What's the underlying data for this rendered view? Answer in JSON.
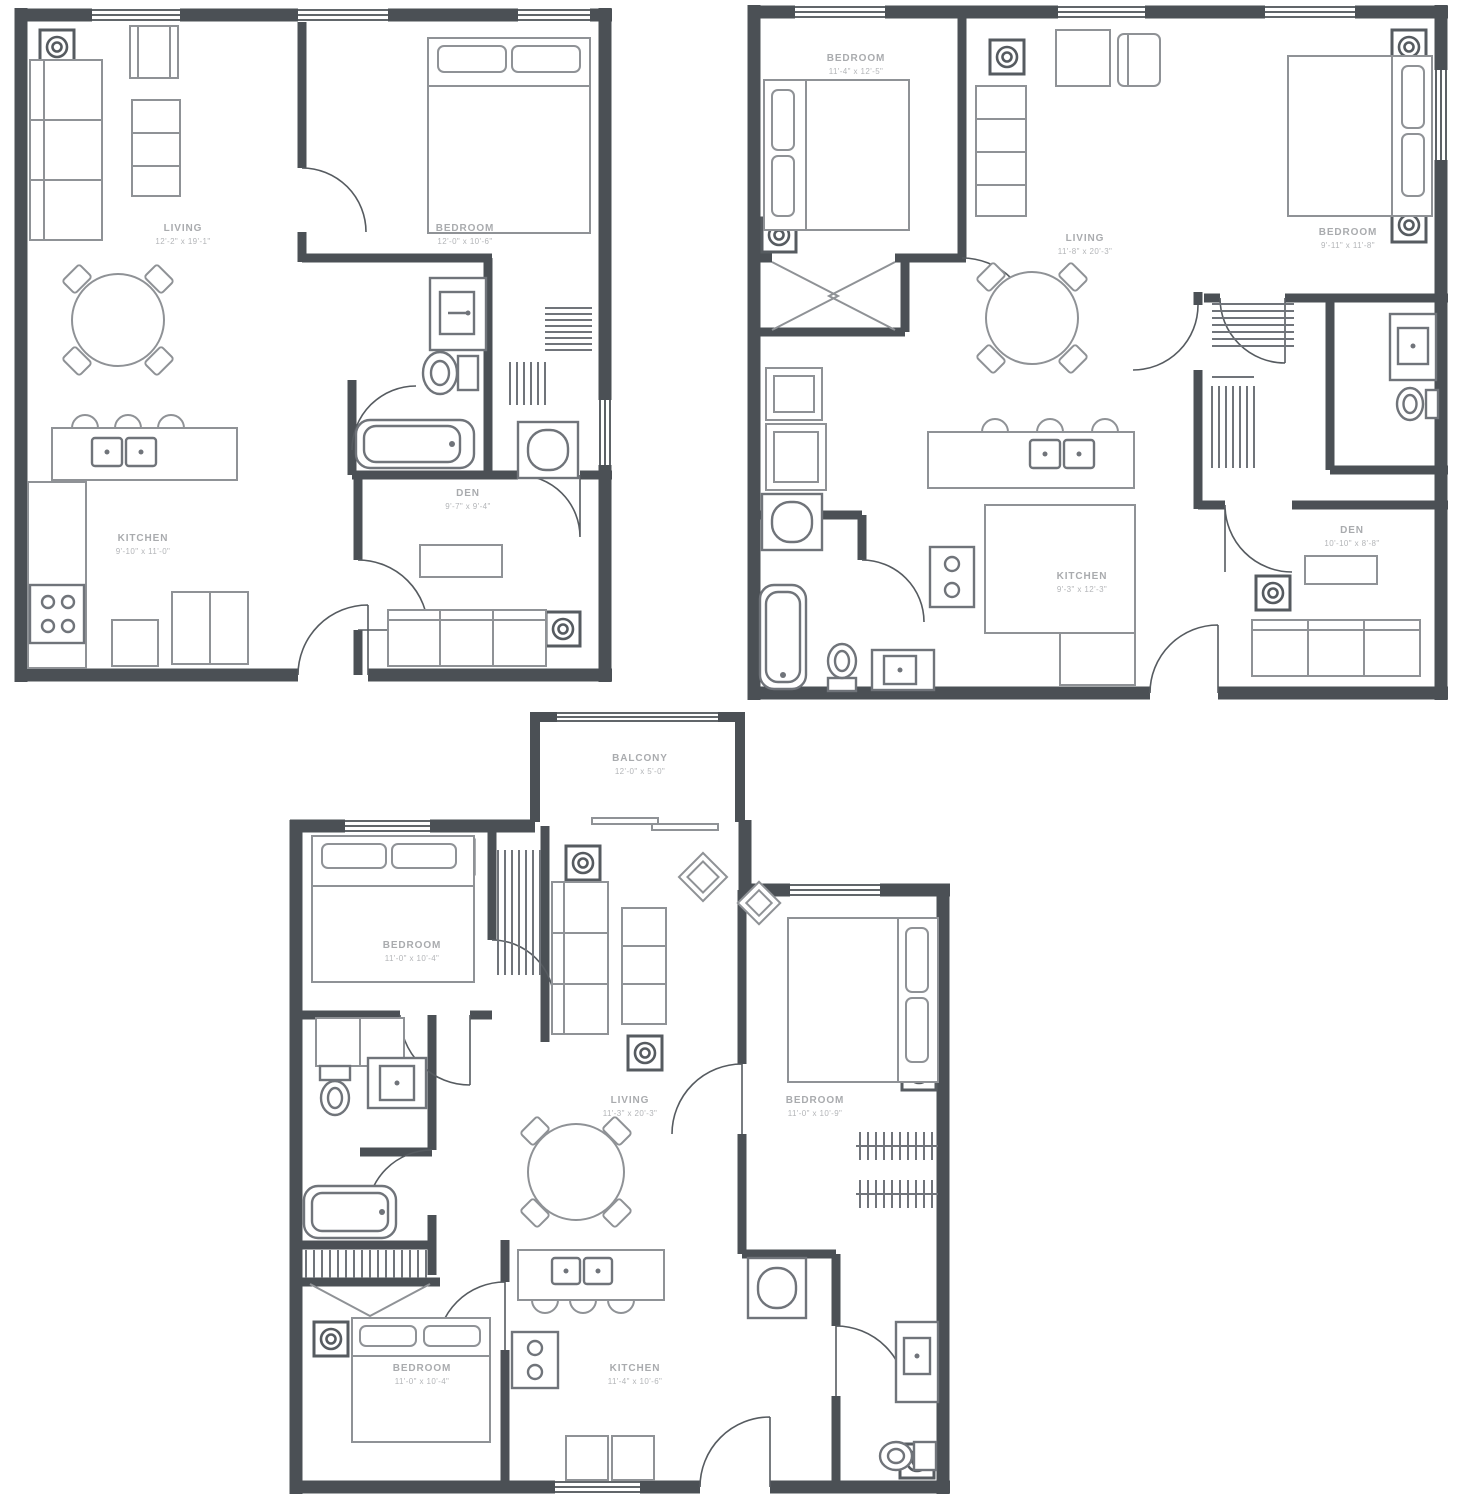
{
  "document": {
    "type": "architectural-floor-plans",
    "units_shown": 3,
    "background": "#ffffff"
  },
  "colors": {
    "wall": "#4b5055",
    "furniture_line": "#8f9296",
    "fixture_line": "#70747a",
    "label_text": "#a9abae"
  },
  "symbols": {
    "ceiling_light": "circle-in-square",
    "closet": "hatched-hanger-lines",
    "door": "quarter-arc-swing",
    "window": "triple-thin-lines"
  },
  "plans": [
    {
      "id": "unit-a",
      "position": "top-left",
      "rooms": [
        {
          "name": "LIVING",
          "dims": "12'-2\" x 19'-1\""
        },
        {
          "name": "BEDROOM",
          "dims": "12'-0\" x 10'-6\""
        },
        {
          "name": "KITCHEN",
          "dims": "9'-10\" x 11'-0\""
        },
        {
          "name": "DEN",
          "dims": "9'-7\" x 9'-4\""
        }
      ]
    },
    {
      "id": "unit-b",
      "position": "top-right",
      "rooms": [
        {
          "name": "BEDROOM",
          "dims": "11'-4\" x 12'-5\""
        },
        {
          "name": "LIVING",
          "dims": "11'-8\" x 20'-3\""
        },
        {
          "name": "BEDROOM",
          "dims": "9'-11\" x 11'-8\""
        },
        {
          "name": "KITCHEN",
          "dims": "9'-3\" x 12'-3\""
        },
        {
          "name": "DEN",
          "dims": "10'-10\" x 8'-8\""
        }
      ]
    },
    {
      "id": "unit-c",
      "position": "bottom-center",
      "rooms": [
        {
          "name": "BALCONY",
          "dims": "12'-0\" x 5'-0\""
        },
        {
          "name": "BEDROOM",
          "dims": "11'-0\" x 10'-4\""
        },
        {
          "name": "LIVING",
          "dims": "11'-3\" x 20'-3\""
        },
        {
          "name": "BEDROOM",
          "dims": "11'-0\" x 10'-9\""
        },
        {
          "name": "BEDROOM",
          "dims": "11'-0\" x 10'-4\""
        },
        {
          "name": "KITCHEN",
          "dims": "11'-4\" x 10'-6\""
        }
      ]
    }
  ]
}
